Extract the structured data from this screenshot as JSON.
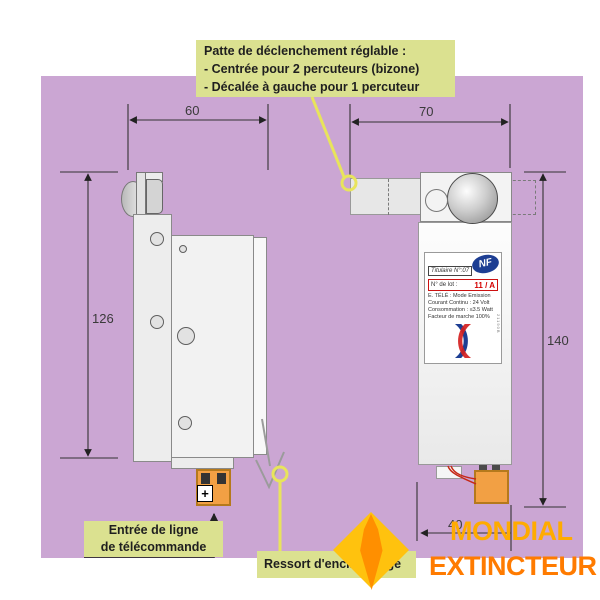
{
  "note_top": {
    "line1": "Patte de déclenchement réglable :",
    "line2": "- Centrée pour 2 percuteurs (bizone)",
    "line3": "- Décalée à gauche pour 1 percuteur"
  },
  "dimensions": {
    "left_width": "60",
    "right_width": "70",
    "left_height": "126",
    "right_height": "140",
    "bottom_depth": "40"
  },
  "product_label": {
    "nf": "NF",
    "titulaire": "Titulaire N°:07",
    "lot_caption": "N° de lot :",
    "lot_value": "11 / A",
    "spec1": "E. TÉLÉ : Mode Emission",
    "spec2": "Courant Continu : 24 Volt",
    "spec3": "Consommation : ≤3.5 Watt",
    "spec4": "Facteur de marche 100%",
    "side_code": "21190B"
  },
  "connector": {
    "plus": "+"
  },
  "note_entree": {
    "line1": "Entrée de ligne",
    "line2": "de télécommande"
  },
  "note_ressort": {
    "text": "Ressort d'encliquetage"
  },
  "brand": {
    "name1": "MONDIAL",
    "name2": "EXTINCTEUR"
  },
  "colors": {
    "background": "#cba6d3",
    "note_fill": "#dbe190",
    "callout_yellow": "#e8e45c",
    "connector_orange": "#f2a044",
    "brand_orange": "#ff7b00",
    "brand_yellow": "#ffc20e",
    "nf_blue": "#1d3e93",
    "lot_red": "#d40000"
  }
}
